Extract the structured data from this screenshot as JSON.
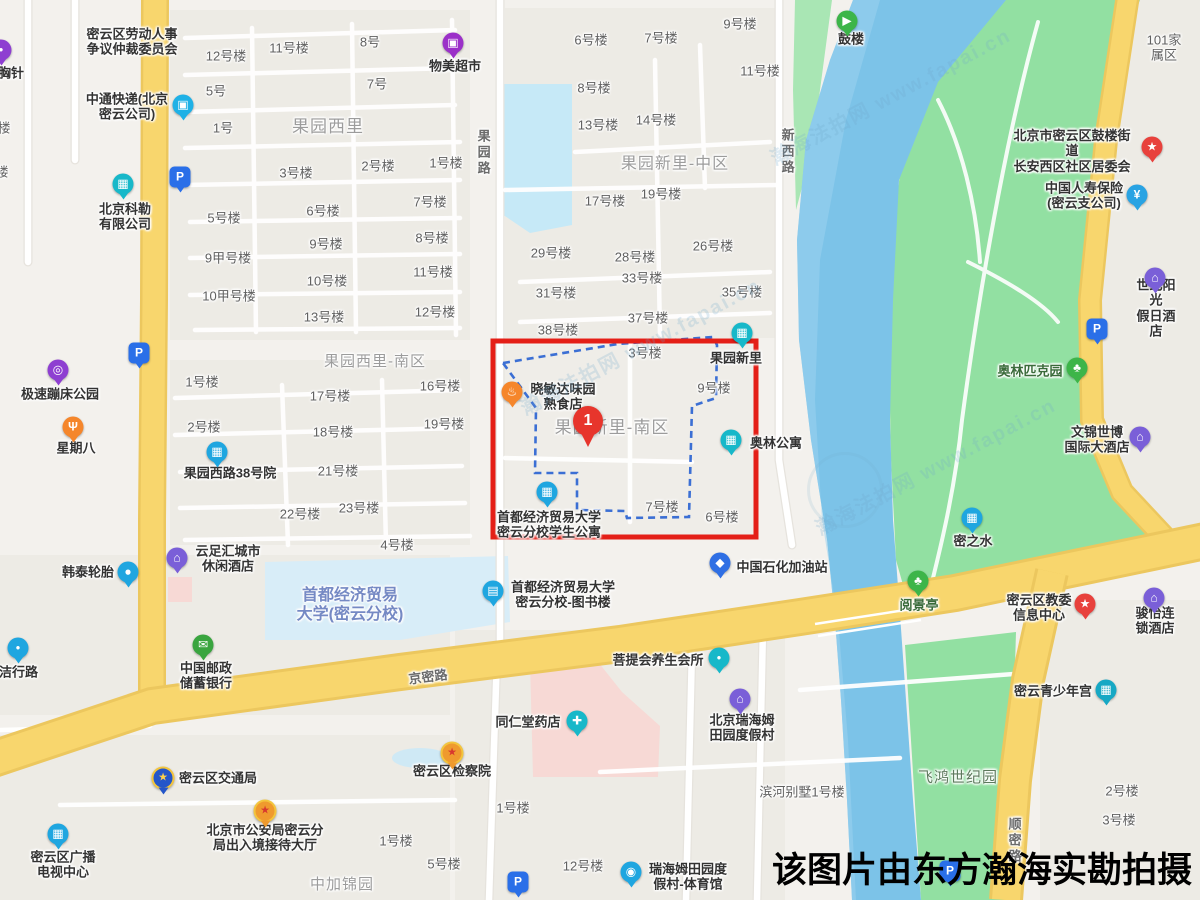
{
  "annotation": {
    "caption": "该图片由东方瀚海实勘拍摄",
    "marker_label": "1"
  },
  "watermark": {
    "site": "瀚海法拍网",
    "url": "www.fapai.cn",
    "items": [
      {
        "x": 890,
        "y": 95
      },
      {
        "x": 935,
        "y": 465
      },
      {
        "x": 640,
        "y": 345
      }
    ],
    "emblem": {
      "x": 845,
      "y": 490
    }
  },
  "colors": {
    "highlight_box": "#e41f17",
    "boundary_dash": "#3b6fd4",
    "marker": "#e7352c",
    "road_yellow": "#f8d66d",
    "river": "#7cc3e8",
    "park": "#92e0a2"
  },
  "highlight": {
    "box": {
      "x": 493,
      "y": 341,
      "w": 263,
      "h": 196
    },
    "marker": {
      "x": 588,
      "y": 447
    },
    "boundary_points": "503,363 618,344 713,337 717,345 716,398 692,406 689,517 627,518 625,511 577,510 577,473 535,473 536,408"
  },
  "map": {
    "area_labels": [
      {
        "t": "果园西里",
        "x": 328,
        "y": 127,
        "fs": 17
      },
      {
        "t": "果园新里-中区",
        "x": 675,
        "y": 165,
        "fs": 16
      },
      {
        "t": "果园西里-南区",
        "x": 375,
        "y": 362,
        "fs": 15
      },
      {
        "t": "果园新里-南区",
        "x": 612,
        "y": 428,
        "fs": 17
      },
      {
        "t": "中加锦园",
        "x": 342,
        "y": 885,
        "fs": 15
      },
      {
        "t": "飞鸿世纪园",
        "x": 958,
        "y": 778,
        "fs": 15,
        "lc": "#5d7a5d"
      }
    ],
    "road_labels": [
      {
        "t": "京密路",
        "x": 428,
        "y": 677,
        "rot": -7
      },
      {
        "t": "果园路",
        "x": 483,
        "y": 153,
        "v": 1
      },
      {
        "t": "新西路",
        "x": 787,
        "y": 152,
        "v": 1
      },
      {
        "t": "顺密路",
        "x": 1014,
        "y": 841,
        "v": 1
      }
    ],
    "building_labels": [
      {
        "t": "12号楼",
        "x": 226,
        "y": 56
      },
      {
        "t": "11号楼",
        "x": 289,
        "y": 48
      },
      {
        "t": "8号",
        "x": 370,
        "y": 42
      },
      {
        "t": "5号",
        "x": 216,
        "y": 91
      },
      {
        "t": "7号",
        "x": 377,
        "y": 84
      },
      {
        "t": "1号",
        "x": 223,
        "y": 128
      },
      {
        "t": "3号楼",
        "x": 296,
        "y": 173
      },
      {
        "t": "2号楼",
        "x": 378,
        "y": 166
      },
      {
        "t": "5号楼",
        "x": 224,
        "y": 218
      },
      {
        "t": "6号楼",
        "x": 323,
        "y": 211
      },
      {
        "t": "9号楼",
        "x": 326,
        "y": 244
      },
      {
        "t": "9甲号楼",
        "x": 228,
        "y": 258
      },
      {
        "t": "10号楼",
        "x": 327,
        "y": 281
      },
      {
        "t": "10甲号楼",
        "x": 229,
        "y": 296
      },
      {
        "t": "13号楼",
        "x": 324,
        "y": 317
      },
      {
        "t": "6号楼",
        "x": 591,
        "y": 40
      },
      {
        "t": "7号楼",
        "x": 661,
        "y": 38
      },
      {
        "t": "9号楼",
        "x": 740,
        "y": 24
      },
      {
        "t": "8号楼",
        "x": 594,
        "y": 88
      },
      {
        "t": "11号楼",
        "x": 760,
        "y": 71
      },
      {
        "t": "13号楼",
        "x": 598,
        "y": 125
      },
      {
        "t": "14号楼",
        "x": 656,
        "y": 120
      },
      {
        "t": "1号楼",
        "x": 446,
        "y": 163
      },
      {
        "t": "17号楼",
        "x": 605,
        "y": 201
      },
      {
        "t": "19号楼",
        "x": 661,
        "y": 194
      },
      {
        "t": "7号楼",
        "x": 430,
        "y": 202
      },
      {
        "t": "8号楼",
        "x": 432,
        "y": 238
      },
      {
        "t": "29号楼",
        "x": 551,
        "y": 253
      },
      {
        "t": "28号楼",
        "x": 635,
        "y": 257
      },
      {
        "t": "26号楼",
        "x": 713,
        "y": 246
      },
      {
        "t": "11号楼",
        "x": 433,
        "y": 272
      },
      {
        "t": "33号楼",
        "x": 642,
        "y": 278
      },
      {
        "t": "31号楼",
        "x": 556,
        "y": 293
      },
      {
        "t": "35号楼",
        "x": 742,
        "y": 292
      },
      {
        "t": "12号楼",
        "x": 435,
        "y": 312
      },
      {
        "t": "37号楼",
        "x": 648,
        "y": 318
      },
      {
        "t": "38号楼",
        "x": 558,
        "y": 330
      },
      {
        "t": "3号楼",
        "x": 645,
        "y": 353
      },
      {
        "t": "9号楼",
        "x": 714,
        "y": 388
      },
      {
        "t": "7号楼",
        "x": 662,
        "y": 507
      },
      {
        "t": "6号楼",
        "x": 722,
        "y": 517
      },
      {
        "t": "1号楼",
        "x": 202,
        "y": 382
      },
      {
        "t": "2号楼",
        "x": 204,
        "y": 427
      },
      {
        "t": "17号楼",
        "x": 330,
        "y": 396
      },
      {
        "t": "18号楼",
        "x": 333,
        "y": 432
      },
      {
        "t": "21号楼",
        "x": 338,
        "y": 471
      },
      {
        "t": "16号楼",
        "x": 440,
        "y": 386
      },
      {
        "t": "19号楼",
        "x": 444,
        "y": 424
      },
      {
        "t": "22号楼",
        "x": 300,
        "y": 514
      },
      {
        "t": "23号楼",
        "x": 359,
        "y": 508
      },
      {
        "t": "4号楼",
        "x": 397,
        "y": 545
      },
      {
        "t": "1号楼",
        "x": 513,
        "y": 808
      },
      {
        "t": "1号楼",
        "x": 396,
        "y": 841
      },
      {
        "t": "5号楼",
        "x": 444,
        "y": 864
      },
      {
        "t": "12号楼",
        "x": 583,
        "y": 866
      },
      {
        "t": "2号楼",
        "x": 1122,
        "y": 791
      },
      {
        "t": "3号楼",
        "x": 1119,
        "y": 820
      },
      {
        "t": "滨河别墅1号楼",
        "x": 802,
        "y": 792
      },
      {
        "t": "101家属区",
        "x": 1164,
        "y": 48
      },
      {
        "t": "楼",
        "x": 4,
        "y": 128
      },
      {
        "t": "楼",
        "x": 2,
        "y": 172
      }
    ],
    "pois": [
      {
        "l": "密云区劳动人事\n争议仲裁委员会",
        "x": 132,
        "y": 42
      },
      {
        "l": "胸针",
        "x": 11,
        "y": 73,
        "i": "dot",
        "ic": "#8e3fd1",
        "ix": 1,
        "iy": 50
      },
      {
        "l": "中通快递(北京\n密云公司)",
        "x": 127,
        "y": 107,
        "i": "truck",
        "ic": "#1fb1e6",
        "ix": 183,
        "iy": 105
      },
      {
        "l": "物美超市",
        "x": 455,
        "y": 66,
        "i": "shop",
        "ic": "#9b30c8",
        "ix": 453,
        "iy": 43
      },
      {
        "l": "北京科勒\n有限公司",
        "x": 125,
        "y": 217,
        "i": "building",
        "ic": "#17b8c9",
        "ix": 123,
        "iy": 184
      },
      {
        "l": "极速蹦床公园",
        "x": 60,
        "y": 394,
        "i": "trampoline",
        "ic": "#8e3fd1",
        "ix": 58,
        "iy": 370
      },
      {
        "l": "星期八",
        "x": 76,
        "y": 448,
        "i": "fork",
        "ic": "#f5862b",
        "ix": 73,
        "iy": 427
      },
      {
        "l": "果园西路38号院",
        "x": 230,
        "y": 473,
        "i": "building",
        "ic": "#1fa6e0",
        "ix": 217,
        "iy": 452
      },
      {
        "l": "云足汇城市\n休闲酒店",
        "x": 228,
        "y": 559,
        "i": "hotel",
        "ic": "#7a5fd8",
        "ix": 177,
        "iy": 558
      },
      {
        "l": "韩泰轮胎",
        "x": 88,
        "y": 572,
        "i": "car",
        "ic": "#1fa6e0",
        "ix": 128,
        "iy": 572
      },
      {
        "l": "于洁行路",
        "x": 12,
        "y": 672,
        "i": "dot",
        "ic": "#1fa6e0",
        "ix": 18,
        "iy": 648
      },
      {
        "l": "中国邮政\n储蓄银行",
        "x": 206,
        "y": 676,
        "i": "postal",
        "ic": "#3aa53f",
        "ix": 203,
        "iy": 645
      },
      {
        "l": "首都经济贸易\n大学(密云分校)",
        "x": 350,
        "y": 606,
        "lc": "#7589c4",
        "fs": 16
      },
      {
        "l": "首都经济贸易大学\n密云分校-图书楼",
        "x": 563,
        "y": 595,
        "i": "book",
        "ic": "#1fa6e0",
        "ix": 493,
        "iy": 591
      },
      {
        "l": "首都经济贸易大学\n密云分校学生公寓",
        "x": 549,
        "y": 525,
        "i": "building",
        "ic": "#1fa6e0",
        "ix": 547,
        "iy": 492
      },
      {
        "l": "晓敏达味园\n熟食店",
        "x": 563,
        "y": 397,
        "i": "food",
        "ic": "#f5862b",
        "ix": 512,
        "iy": 392
      },
      {
        "l": "中国石化加油站",
        "x": 782,
        "y": 567,
        "i": "fuel",
        "ic": "#2f6fe4",
        "ix": 720,
        "iy": 563
      },
      {
        "l": "果园新里",
        "x": 736,
        "y": 358,
        "i": "building",
        "ic": "#17b8c9",
        "ix": 742,
        "iy": 333
      },
      {
        "l": "奥林公寓",
        "x": 776,
        "y": 443,
        "i": "building",
        "ic": "#17b8c9",
        "ix": 731,
        "iy": 440
      },
      {
        "l": "鼓楼",
        "x": 851,
        "y": 39,
        "i": "arrow",
        "ic": "#3db549",
        "ix": 847,
        "iy": 21
      },
      {
        "l": "北京市密云区鼓楼街道\n长安西区社区居委会",
        "x": 1072,
        "y": 151,
        "i": "star",
        "ic": "#e8413c",
        "ix": 1152,
        "iy": 147
      },
      {
        "l": "中国人寿保险\n(密云支公司)",
        "x": 1084,
        "y": 196,
        "i": "yen",
        "ic": "#29a3e3",
        "ix": 1137,
        "iy": 195
      },
      {
        "l": "世纪阳光\n假日酒店",
        "x": 1156,
        "y": 308,
        "i": "hotel",
        "ic": "#7a5fd8",
        "ix": 1155,
        "iy": 278
      },
      {
        "l": "奥林匹克园",
        "x": 1030,
        "y": 371,
        "lc": "#3a6b3a",
        "i": "tree",
        "ic": "#3db549",
        "ix": 1077,
        "iy": 368
      },
      {
        "l": "文锦世博\n国际大酒店",
        "x": 1097,
        "y": 440,
        "i": "hotel",
        "ic": "#7a5fd8",
        "ix": 1140,
        "iy": 437
      },
      {
        "l": "密之水",
        "x": 973,
        "y": 541,
        "i": "building",
        "ic": "#1fa6e0",
        "ix": 972,
        "iy": 518
      },
      {
        "l": "阅景亭",
        "x": 919,
        "y": 605,
        "lc": "#3a6b3a",
        "i": "tree",
        "ic": "#3db549",
        "ix": 918,
        "iy": 581
      },
      {
        "l": "密云区教委\n信息中心",
        "x": 1039,
        "y": 608,
        "i": "star",
        "ic": "#e8413c",
        "ix": 1085,
        "iy": 604
      },
      {
        "l": "骏怡连锁酒店",
        "x": 1155,
        "y": 621,
        "i": "hotel",
        "ic": "#7a5fd8",
        "ix": 1154,
        "iy": 598
      },
      {
        "l": "密云青少年宫",
        "x": 1053,
        "y": 691,
        "i": "museum",
        "ic": "#17a8c4",
        "ix": 1106,
        "iy": 690
      },
      {
        "l": "菩提会养生会所",
        "x": 658,
        "y": 660,
        "i": "dot",
        "ic": "#17b8c9",
        "ix": 719,
        "iy": 658
      },
      {
        "l": "同仁堂药店",
        "x": 528,
        "y": 722,
        "i": "pill",
        "ic": "#17b8c9",
        "ix": 577,
        "iy": 721
      },
      {
        "l": "北京瑞海姆\n田园度假村",
        "x": 742,
        "y": 728,
        "i": "hotel",
        "ic": "#7a5fd8",
        "ix": 740,
        "iy": 699
      },
      {
        "l": "瑞海姆田园度\n假村-体育馆",
        "x": 688,
        "y": 877,
        "i": "sports",
        "ic": "#1fa6e0",
        "ix": 631,
        "iy": 872
      },
      {
        "l": "密云区检察院",
        "x": 452,
        "y": 771,
        "i": "badge",
        "ic": "#ef9a2e",
        "gc": "#d8382e",
        "ix": 452,
        "iy": 753
      },
      {
        "l": "北京市公安局密云分\n局出入境接待大厅",
        "x": 265,
        "y": 838,
        "i": "badge",
        "ic": "#ef9a2e",
        "gc": "#d8382e",
        "ix": 265,
        "iy": 811
      },
      {
        "l": "密云区交通局",
        "x": 218,
        "y": 778,
        "i": "badge",
        "ic": "#2456c9",
        "gc": "#ffd24a",
        "ix": 163,
        "iy": 778
      },
      {
        "l": "密云区广播\n电视中心",
        "x": 63,
        "y": 865,
        "i": "building",
        "ic": "#1fa6e0",
        "ix": 58,
        "iy": 834
      },
      {
        "l": "",
        "x": 0,
        "y": 0,
        "i": "parking",
        "ic": "#2a6fe8",
        "ix": 180,
        "iy": 177
      },
      {
        "l": "",
        "x": 0,
        "y": 0,
        "i": "parking",
        "ic": "#2a6fe8",
        "ix": 139,
        "iy": 353
      },
      {
        "l": "",
        "x": 0,
        "y": 0,
        "i": "parking",
        "ic": "#2a6fe8",
        "ix": 1097,
        "iy": 329
      },
      {
        "l": "",
        "x": 0,
        "y": 0,
        "i": "parking",
        "ic": "#2a6fe8",
        "ix": 518,
        "iy": 882
      },
      {
        "l": "",
        "x": 0,
        "y": 0,
        "i": "parking",
        "ic": "#2a6fe8",
        "ix": 950,
        "iy": 871
      }
    ]
  }
}
